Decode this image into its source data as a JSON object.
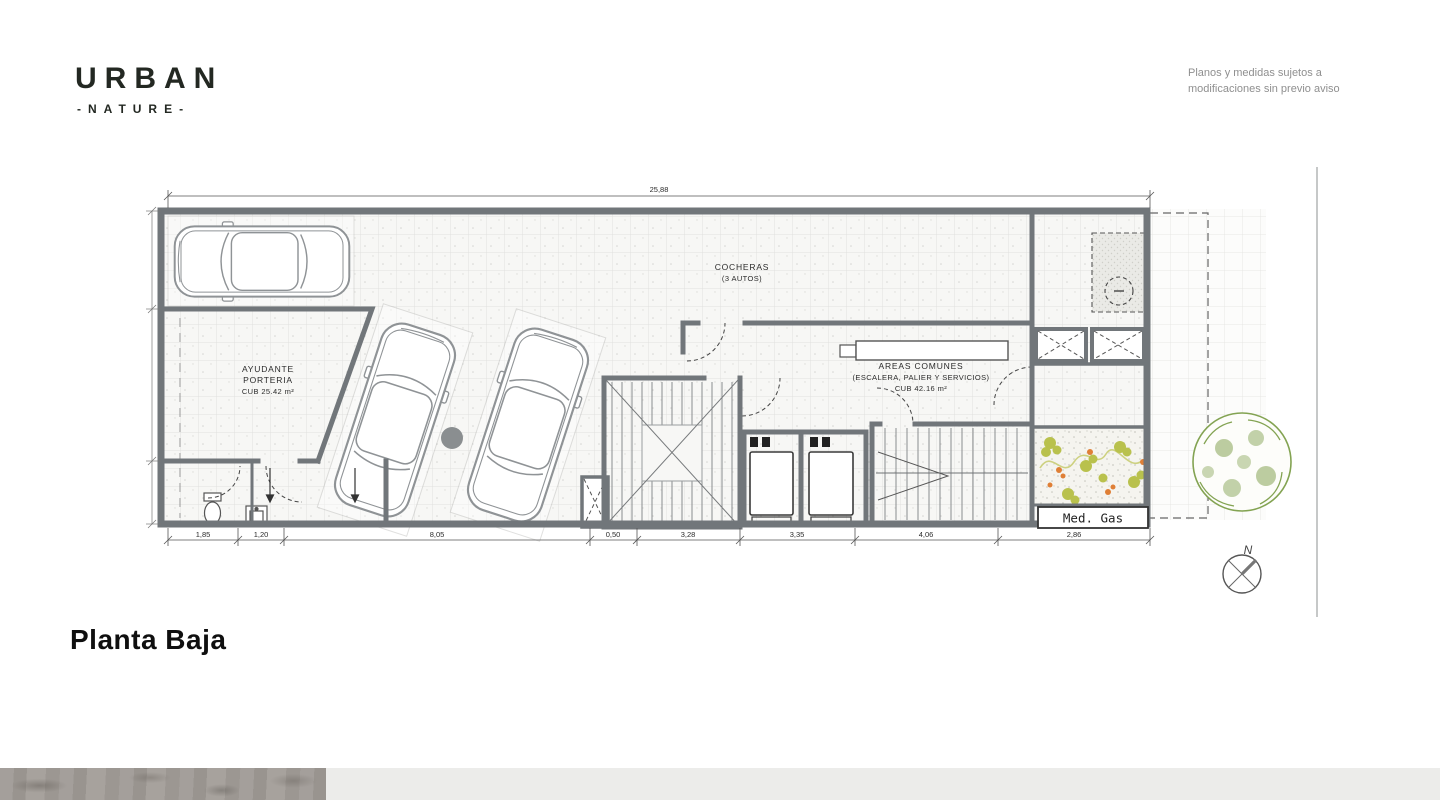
{
  "brand": {
    "name": "URBAN",
    "tagline": "-NATURE-"
  },
  "disclaimer": {
    "line1": "Planos y medidas sujetos a",
    "line2": "modificaciones sin previo aviso"
  },
  "title": "Planta Baja",
  "plan": {
    "rooms": {
      "cocheras": {
        "label": "COCHERAS",
        "sublabel": "(3 AUTOS)"
      },
      "ayudante": {
        "line1": "AYUDANTE",
        "line2": "PORTERIA",
        "area": "CUB 25.42 m²"
      },
      "areas_comunes": {
        "line1": "AREAS COMUNES",
        "line2": "(ESCALERA, PALIER Y SERVICIOS)",
        "area": "CUB 42.16 m²"
      },
      "med_gas": {
        "label": "Med. Gas"
      }
    },
    "dimensions": {
      "total_width": "25,88",
      "bottom": [
        "1,85",
        "1,20",
        "8,05",
        "0,50",
        "3,28",
        "3,35",
        "4,06",
        "2,86"
      ]
    },
    "compass": {
      "north_label": "N"
    }
  },
  "colors": {
    "wall_gray": "#71767a",
    "tile_line": "#e0e0de",
    "tree_green": "#83a352",
    "plant_green": "#b9c14d",
    "flower_orange": "#df7f36",
    "text_dark": "#1d1d1b",
    "disclaimer_gray": "#8f8f8f"
  }
}
